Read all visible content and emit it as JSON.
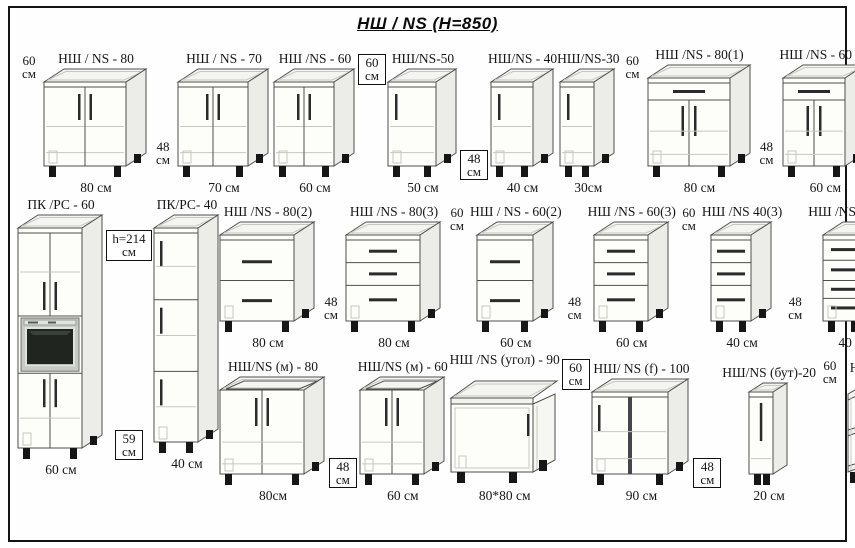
{
  "title": "НШ / NS  (H=850)",
  "colors": {
    "outline": "#4f4f4c",
    "interior_line": "#c8c8c2",
    "handle": "#2b2b2b",
    "foot": "#161616",
    "oven_frame": "#c6cbc6",
    "oven_window": "#20261f"
  },
  "row1": {
    "items": [
      {
        "type": "dim",
        "text": "60 см",
        "boxed": false,
        "pos": "top"
      },
      {
        "type": "unit",
        "label": "НШ / NS - 80",
        "size": "80 см",
        "kind": "doors2",
        "w": 82,
        "h": 84
      },
      {
        "type": "dim",
        "text": "48 см",
        "boxed": false,
        "pos": "bottom"
      },
      {
        "type": "unit",
        "label": "НШ / NS - 70",
        "size": "70 см",
        "kind": "doors2",
        "w": 70,
        "h": 84
      },
      {
        "type": "unit",
        "label": "НШ /NS - 60",
        "size": "60 см",
        "kind": "doors2",
        "w": 60,
        "h": 84
      },
      {
        "type": "dim",
        "text": "60 см",
        "boxed": true,
        "pos": "top"
      },
      {
        "type": "unit",
        "label": "НШ/NS-50",
        "size": "50 см",
        "kind": "doors1",
        "w": 48,
        "h": 84
      },
      {
        "type": "dim",
        "text": "48 см",
        "boxed": true,
        "pos": "bottom"
      },
      {
        "type": "unit",
        "label": "НШ/NS - 40",
        "size": "40 см",
        "kind": "doors1",
        "w": 42,
        "h": 84
      },
      {
        "type": "unit",
        "label": "НШ/NS-30",
        "size": "30см",
        "kind": "doors1",
        "w": 34,
        "h": 84
      },
      {
        "type": "dim",
        "text": "60 см",
        "boxed": false,
        "pos": "top"
      },
      {
        "type": "unit",
        "label": "НШ /NS - 80(1)",
        "size": "80 см",
        "kind": "drawer1doors2",
        "w": 82,
        "h": 88
      },
      {
        "type": "dim",
        "text": "48 см",
        "boxed": false,
        "pos": "bottom"
      },
      {
        "type": "unit",
        "label": "НШ /NS - 60 (1)",
        "size": "60 см",
        "kind": "drawer1doors2",
        "w": 62,
        "h": 88
      }
    ]
  },
  "tall": {
    "items": [
      {
        "type": "unit",
        "label": "ПК /РС - 60",
        "size": "60 см",
        "kind": "tall_oven",
        "w": 64,
        "h": 220
      },
      {
        "type": "labels",
        "top": "h=214 см",
        "bottom": "59 см"
      },
      {
        "type": "unit",
        "label": "ПК/РС- 40",
        "size": "40 см",
        "kind": "tall3",
        "w": 44,
        "h": 214
      }
    ]
  },
  "row2": {
    "items": [
      {
        "type": "unit",
        "label": "НШ /NS - 80(2)",
        "size": "80 см",
        "kind": "drawers2",
        "w": 74,
        "h": 86
      },
      {
        "type": "dim",
        "text": "48 см",
        "boxed": false,
        "pos": "bottom"
      },
      {
        "type": "unit",
        "label": "НШ /NS - 80(3)",
        "size": "80 см",
        "kind": "drawers3",
        "w": 74,
        "h": 86
      },
      {
        "type": "dim",
        "text": "60 см",
        "boxed": false,
        "pos": "top"
      },
      {
        "type": "unit",
        "label": "НШ / NS - 60(2)",
        "size": "60 см",
        "kind": "drawers2",
        "w": 56,
        "h": 86
      },
      {
        "type": "dim",
        "text": "48 см",
        "boxed": false,
        "pos": "bottom"
      },
      {
        "type": "unit",
        "label": "НШ /NS - 60(3)",
        "size": "60 см",
        "kind": "drawers3",
        "w": 54,
        "h": 86
      },
      {
        "type": "dim",
        "text": "60 см",
        "boxed": false,
        "pos": "top"
      },
      {
        "type": "unit",
        "label": "НШ /NS 40(3)",
        "size": "40 см",
        "kind": "drawers3",
        "w": 40,
        "h": 86
      },
      {
        "type": "dim",
        "text": "48 см",
        "boxed": false,
        "pos": "bottom"
      },
      {
        "type": "unit",
        "label": "НШ /NS - 40 (х)",
        "size": "40 см",
        "kind": "drawers4",
        "w": 40,
        "h": 86
      }
    ]
  },
  "row3": {
    "items": [
      {
        "type": "unit",
        "label": "НШ/NS (м) - 80",
        "size": "80см",
        "kind": "sink2",
        "w": 84,
        "h": 84
      },
      {
        "type": "dim",
        "text": "48 см",
        "boxed": true,
        "pos": "bottom"
      },
      {
        "type": "unit",
        "label": "НШ/NS (м) - 60",
        "size": "60 см",
        "kind": "sink2",
        "w": 64,
        "h": 84
      },
      {
        "type": "unit",
        "label": "НШ /NS (угол) - 90",
        "size": "80*80 см",
        "kind": "corner",
        "w": 112,
        "h": 120
      },
      {
        "type": "dim",
        "text": "60 см",
        "boxed": true,
        "pos": "top"
      },
      {
        "type": "unit",
        "label": "НШ/ NS (f) - 100",
        "size": "90 см",
        "kind": "wide2",
        "w": 76,
        "h": 82
      },
      {
        "type": "dim",
        "text": "48 см",
        "boxed": true,
        "pos": "bottom"
      },
      {
        "type": "unit",
        "label": "НШ/NS (бут)-20",
        "size": "20 см",
        "kind": "bottle",
        "w": 24,
        "h": 82
      },
      {
        "type": "dim",
        "text": "60 см",
        "boxed": false,
        "pos": "top"
      },
      {
        "type": "unit",
        "label": "НУ - 30",
        "size": "30 см",
        "kind": "open_corner",
        "w": 56,
        "h": 112
      }
    ]
  }
}
